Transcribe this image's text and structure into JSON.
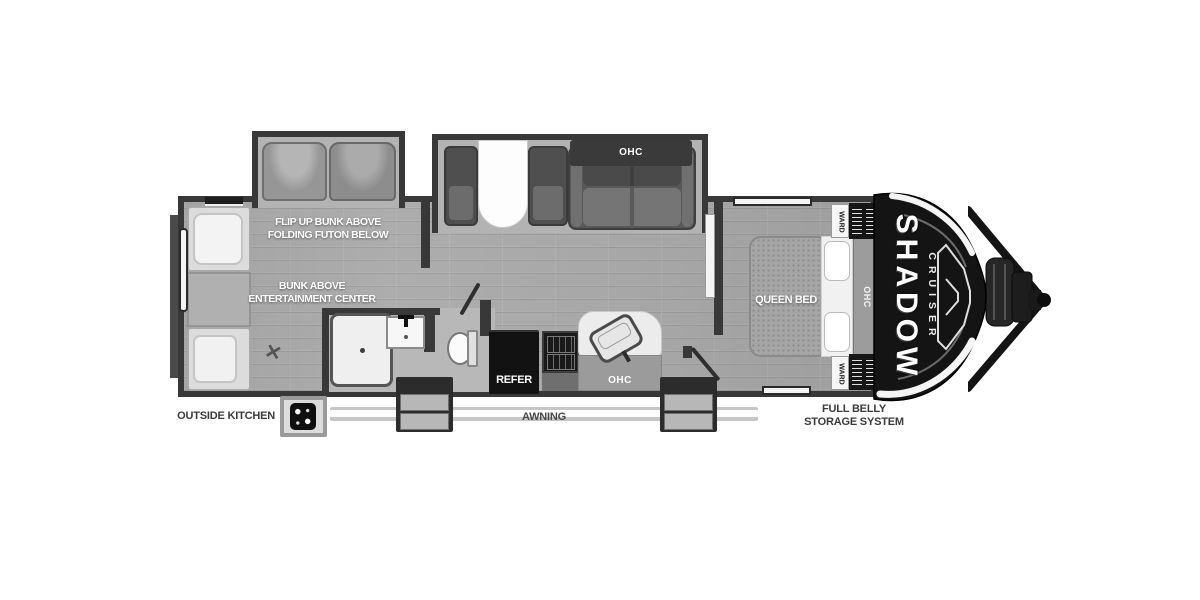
{
  "title": "Shadow Cruiser travel trailer floor plan",
  "colors": {
    "wall": "#383838",
    "floor": "#a7a7a7",
    "slide_floor": "#b3b3b3",
    "bath_floor": "#b8b8b8",
    "cap": "#141414",
    "appliance_dark": "#121212",
    "white": "#f2f2f2",
    "label_dark": "#3b3b3b",
    "awning": "#c6c6c6"
  },
  "bunk_room": {
    "flip_up_line1": "FLIP UP BUNK ABOVE",
    "flip_up_line2": "FOLDING FUTON BELOW",
    "bunk_line1": "BUNK ABOVE",
    "bunk_line2": "ENTERTAINMENT CENTER"
  },
  "living_area": {
    "sofa_ohc": "OHC"
  },
  "kitchen": {
    "refer": "REFER",
    "ohc": "OHC"
  },
  "bedroom": {
    "bed": "QUEEN BED",
    "headboard_ohc": "OHC",
    "ward_top": "WARD",
    "ward_bottom": "WARD"
  },
  "exterior": {
    "outside_kitchen": "OUTSIDE KITCHEN",
    "awning": "AWNING",
    "full_belly_line1": "FULL BELLY",
    "full_belly_line2": "STORAGE SYSTEM"
  },
  "brand": {
    "line1": "SHADOW",
    "line2": "CRUISER"
  }
}
